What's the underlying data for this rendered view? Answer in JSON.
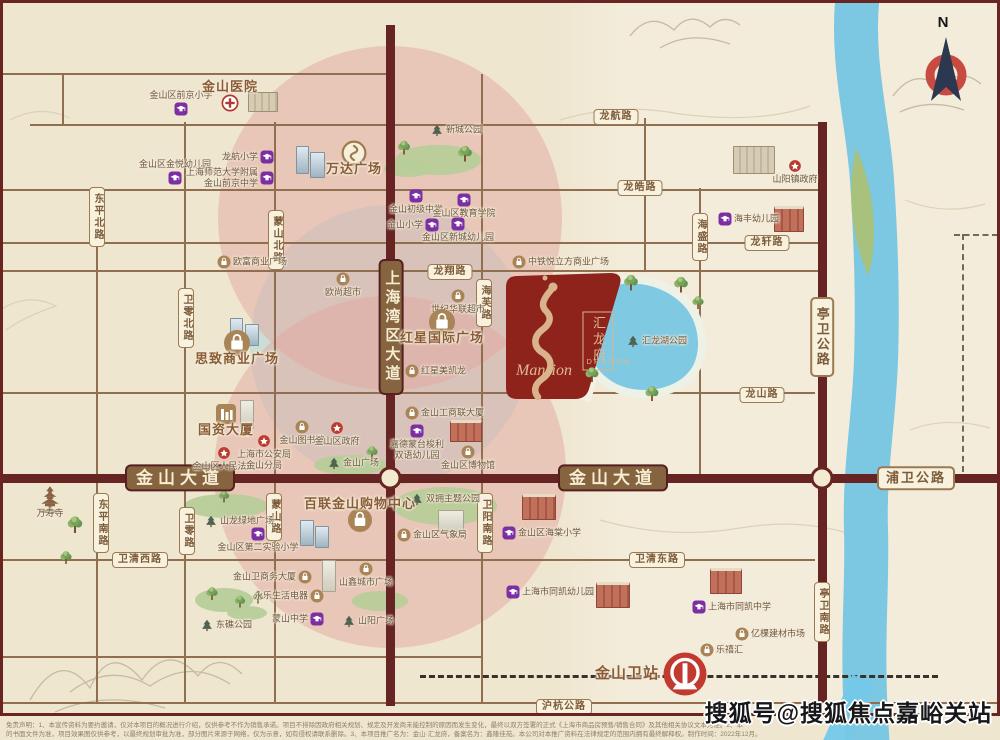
{
  "colors": {
    "background": "#efe6d0",
    "road_minor": "#8f6f50",
    "road_major": "#662423",
    "brand_red": "#8e231c",
    "dragon_gold": "#d8b38c",
    "lake_blue": "#7fc9e3",
    "river_blue": "#7cc7e2",
    "edu_purple": "#7c2fa3",
    "gov_red": "#bb3a2e",
    "shop_brown": "#a88457",
    "ring_pink": "#e3a8a0",
    "ring_blue": "#c6dbd5"
  },
  "property": {
    "name_cn": "汇龙府",
    "en_line1": "DRAGON",
    "en_line2": "Mansion"
  },
  "north": {
    "label": "N"
  },
  "watermark": {
    "text": "搜狐号@搜狐焦点嘉峪关站"
  },
  "disclaimer": {
    "line1": "免责声明：1、本宣传资料为要约邀请，仅对本项目的概况进行介绍，仅供参考不作为销售承诺。项目不排除因政府相关规划、规定及开发商未能控制的原因而发生变化，最终以双方签署的正式《上海市商品房预售/销售合同》及其他相关协议文本为准。2、本",
    "line2": "的书面文件为准，项目效果图仅供参考，以最终规划审批为准，部分图片来源于网络，仅为示意，如有侵权请联系删除。3、本项目推广名为：金山·汇龙府，备案名为：鑫隆佳苑。本公司对本推广资料在法律规定的范围内拥有最终解释权。制作时间：2022年12月。"
  },
  "station": {
    "label": "金山卫站"
  },
  "road_labels": [
    {
      "t": "龙航路",
      "x": 616,
      "y": 117,
      "o": "h",
      "k": "s"
    },
    {
      "t": "龙皓路",
      "x": 640,
      "y": 188,
      "o": "h",
      "k": "s"
    },
    {
      "t": "龙轩路",
      "x": 767,
      "y": 243,
      "o": "h",
      "k": "s"
    },
    {
      "t": "龙翔路",
      "x": 450,
      "y": 272,
      "o": "h",
      "k": "s"
    },
    {
      "t": "龙山路",
      "x": 762,
      "y": 395,
      "o": "h",
      "k": "s"
    },
    {
      "t": "卫清西路",
      "x": 140,
      "y": 560,
      "o": "h",
      "k": "s"
    },
    {
      "t": "卫清东路",
      "x": 657,
      "y": 560,
      "o": "h",
      "k": "s"
    },
    {
      "t": "沪杭公路",
      "x": 564,
      "y": 707,
      "o": "h",
      "k": "s"
    },
    {
      "t": "海芙路",
      "x": 484,
      "y": 303,
      "o": "v",
      "k": "s"
    },
    {
      "t": "海盛路",
      "x": 700,
      "y": 237,
      "o": "v",
      "k": "s"
    },
    {
      "t": "东平北路",
      "x": 97,
      "y": 217,
      "o": "v",
      "k": "s"
    },
    {
      "t": "卫零北路",
      "x": 186,
      "y": 318,
      "o": "v",
      "k": "s"
    },
    {
      "t": "蒙山北路",
      "x": 276,
      "y": 240,
      "o": "v",
      "k": "s"
    },
    {
      "t": "东平南路",
      "x": 101,
      "y": 523,
      "o": "v",
      "k": "s"
    },
    {
      "t": "卫零路",
      "x": 187,
      "y": 531,
      "o": "v",
      "k": "s"
    },
    {
      "t": "蒙山路",
      "x": 274,
      "y": 517,
      "o": "v",
      "k": "s"
    },
    {
      "t": "卫阳南路",
      "x": 485,
      "y": 523,
      "o": "v",
      "k": "s"
    },
    {
      "t": "亭卫南路",
      "x": 822,
      "y": 612,
      "o": "v",
      "k": "s"
    },
    {
      "t": "亭卫公路",
      "x": 822,
      "y": 337,
      "o": "v",
      "k": "sec"
    },
    {
      "t": "浦卫公路",
      "x": 916,
      "y": 478,
      "o": "h",
      "k": "sec"
    },
    {
      "t": "金山大道",
      "x": 180,
      "y": 478,
      "o": "h",
      "k": "m"
    },
    {
      "t": "金山大道",
      "x": 613,
      "y": 478,
      "o": "h",
      "k": "m"
    },
    {
      "t": "上海湾区大道",
      "x": 391,
      "y": 327,
      "o": "v",
      "k": "m"
    }
  ],
  "roads": {
    "h": [
      {
        "y": 74,
        "x1": 3,
        "x2": 390
      },
      {
        "y": 125,
        "x1": 30,
        "x2": 820
      },
      {
        "y": 190,
        "x1": 3,
        "x2": 820
      },
      {
        "y": 243,
        "x1": 3,
        "x2": 818
      },
      {
        "y": 271,
        "x1": 3,
        "x2": 818
      },
      {
        "y": 393,
        "x1": 3,
        "x2": 815
      },
      {
        "y": 560,
        "x1": 3,
        "x2": 815
      },
      {
        "y": 657,
        "x1": 3,
        "x2": 482
      },
      {
        "y": 703,
        "x1": 3,
        "x2": 997
      }
    ],
    "v": [
      {
        "x": 63,
        "y1": 74,
        "y2": 125
      },
      {
        "x": 97,
        "y1": 190,
        "y2": 703
      },
      {
        "x": 185,
        "y1": 122,
        "y2": 703
      },
      {
        "x": 275,
        "y1": 122,
        "y2": 703
      },
      {
        "x": 482,
        "y1": 74,
        "y2": 703
      },
      {
        "x": 645,
        "y1": 118,
        "y2": 272
      },
      {
        "x": 700,
        "y1": 188,
        "y2": 478
      }
    ],
    "major_h": [
      {
        "y": 478,
        "x1": 0,
        "x2": 1000
      }
    ],
    "major_v": [
      {
        "x": 390,
        "y1": 25,
        "y2": 706
      },
      {
        "x": 822,
        "y1": 122,
        "y2": 703
      }
    ],
    "railway": {
      "y": 675,
      "x1": 420,
      "x2": 938
    },
    "nodes": [
      {
        "x": 390,
        "y": 478
      },
      {
        "x": 822,
        "y": 478
      }
    ],
    "dashes": [
      {
        "o": "h",
        "x": 954,
        "y": 234,
        "len": 44
      },
      {
        "o": "v",
        "x": 962,
        "y": 234,
        "len": 238
      }
    ]
  },
  "pois": [
    {
      "ic": "edu",
      "t": "金山区前京小学",
      "x": 181,
      "y": 109,
      "side": "t"
    },
    {
      "ic": "edu",
      "t": "金山区金悦幼儿园",
      "x": 175,
      "y": 178,
      "side": "t"
    },
    {
      "ic": "edu",
      "t": "龙航小学",
      "x": 267,
      "y": 157,
      "side": "l"
    },
    {
      "ic": "edu",
      "t": [
        "上海师范大学附属",
        "金山前京中学"
      ],
      "x": 267,
      "y": 178,
      "side": "l"
    },
    {
      "ic": "edu",
      "t": "金山初级中学",
      "x": 416,
      "y": 196,
      "side": "b"
    },
    {
      "ic": "edu",
      "t": "金山区教育学院",
      "x": 464,
      "y": 200,
      "side": "b"
    },
    {
      "ic": "edu",
      "t": "金山小学",
      "x": 432,
      "y": 225,
      "side": "l"
    },
    {
      "ic": "edu",
      "t": "金山区新城幼儿园",
      "x": 458,
      "y": 224,
      "side": "b"
    },
    {
      "ic": "edu",
      "t": "海丰幼儿园",
      "x": 725,
      "y": 219,
      "side": "r"
    },
    {
      "ic": "edu",
      "t": [
        "嘉德蒙台梭利",
        "双语幼儿园"
      ],
      "x": 417,
      "y": 431,
      "side": "b"
    },
    {
      "ic": "edu",
      "t": "金山区第二实验小学",
      "x": 258,
      "y": 534,
      "side": "b"
    },
    {
      "ic": "edu",
      "t": "金山区海棠小学",
      "x": 509,
      "y": 533,
      "side": "r"
    },
    {
      "ic": "edu",
      "t": "蒙山中学",
      "x": 317,
      "y": 619,
      "side": "l"
    },
    {
      "ic": "edu",
      "t": "上海市同凯幼儿园",
      "x": 513,
      "y": 592,
      "side": "r"
    },
    {
      "ic": "edu",
      "t": "上海市同凯中学",
      "x": 699,
      "y": 607,
      "side": "r"
    },
    {
      "ic": "shop",
      "t": "欧富商业广场",
      "x": 224,
      "y": 262,
      "side": "r"
    },
    {
      "ic": "shop",
      "t": "欧尚超市",
      "x": 343,
      "y": 279,
      "side": "b"
    },
    {
      "ic": "shop",
      "t": "世纪华联超市",
      "x": 458,
      "y": 296,
      "side": "b"
    },
    {
      "ic": "shop",
      "t": "中铁悦立方商业广场",
      "x": 519,
      "y": 262,
      "side": "r"
    },
    {
      "ic": "shop",
      "t": "红星美凯龙",
      "x": 412,
      "y": 371,
      "side": "r"
    },
    {
      "ic": "shop",
      "t": "金山工商联大厦",
      "x": 412,
      "y": 413,
      "side": "r"
    },
    {
      "ic": "shop",
      "t": "金山图书馆",
      "x": 302,
      "y": 427,
      "side": "b"
    },
    {
      "ic": "shop",
      "t": "金山区博物馆",
      "x": 468,
      "y": 452,
      "side": "b"
    },
    {
      "ic": "shop",
      "t": "山鑫城市广场",
      "x": 366,
      "y": 569,
      "side": "b"
    },
    {
      "ic": "shop",
      "t": "金山卫商务大厦",
      "x": 305,
      "y": 577,
      "side": "l"
    },
    {
      "ic": "shop",
      "t": "永乐生活电器",
      "x": 317,
      "y": 596,
      "side": "l"
    },
    {
      "ic": "shop",
      "t": "亿棵建材市场",
      "x": 742,
      "y": 634,
      "side": "r"
    },
    {
      "ic": "shop",
      "t": "乐禧汇",
      "x": 707,
      "y": 650,
      "side": "r"
    },
    {
      "ic": "shop",
      "t": "金山区气象局",
      "x": 404,
      "y": 535,
      "side": "r"
    },
    {
      "ic": "hospital",
      "t": "金山医院",
      "x": 230,
      "y": 103,
      "side": "t",
      "big": true,
      "s": 17
    },
    {
      "ic": "gov",
      "t": "山阳镇政府",
      "x": 795,
      "y": 166,
      "side": "b"
    },
    {
      "ic": "gov",
      "t": "金山区政府",
      "x": 337,
      "y": 428,
      "side": "b"
    },
    {
      "ic": "gov",
      "t": "金山区人民法院",
      "x": 224,
      "y": 453,
      "side": "b"
    },
    {
      "ic": "gov",
      "t": [
        "上海市公安局",
        "金山分局"
      ],
      "x": 264,
      "y": 441,
      "side": "b"
    },
    {
      "ic": "park",
      "t": "新城公园",
      "x": 437,
      "y": 130,
      "side": "r"
    },
    {
      "ic": "park",
      "t": "金山广场",
      "x": 334,
      "y": 463,
      "side": "r"
    },
    {
      "ic": "park",
      "t": "双拥主题公园",
      "x": 417,
      "y": 499,
      "side": "r"
    },
    {
      "ic": "park",
      "t": "山阳广场",
      "x": 349,
      "y": 621,
      "side": "r"
    },
    {
      "ic": "park",
      "t": "东礁公园",
      "x": 207,
      "y": 625,
      "side": "r"
    },
    {
      "ic": "park",
      "t": "汇龙湖公园",
      "x": 633,
      "y": 341,
      "side": "r"
    },
    {
      "ic": "park",
      "t": "山龙绿地广场",
      "x": 211,
      "y": 521,
      "side": "r"
    },
    {
      "ic": "temple",
      "t": "万寿寺",
      "x": 50,
      "y": 500,
      "side": "b",
      "s": 30
    },
    {
      "ic": "wanda",
      "t": "万达广场",
      "x": 354,
      "y": 153,
      "side": "b",
      "big": true,
      "s": 26
    },
    {
      "ic": "bag",
      "t": "红星国际广场",
      "x": 442,
      "y": 322,
      "side": "b",
      "big": true,
      "s": 26
    },
    {
      "ic": "bag",
      "t": "思致商业广场",
      "x": 237,
      "y": 343,
      "side": "b",
      "big": true,
      "s": 26
    },
    {
      "ic": "office",
      "t": "国资大厦",
      "x": 226,
      "y": 414,
      "side": "b",
      "big": true,
      "s": 20
    },
    {
      "ic": "bag",
      "t": "百联金山购物中心",
      "x": 360,
      "y": 520,
      "side": "t",
      "big": true,
      "s": 24
    },
    {
      "ic": "stationIc",
      "t": "金山卫站",
      "x": 685,
      "y": 674,
      "side": "l",
      "big": true,
      "s": 46,
      "cls": "station"
    }
  ],
  "trees": [
    {
      "x": 404,
      "y": 150,
      "s": 14
    },
    {
      "x": 465,
      "y": 156,
      "s": 16
    },
    {
      "x": 631,
      "y": 285,
      "s": 16
    },
    {
      "x": 681,
      "y": 287,
      "s": 16
    },
    {
      "x": 592,
      "y": 377,
      "s": 15
    },
    {
      "x": 698,
      "y": 305,
      "s": 13
    },
    {
      "x": 75,
      "y": 527,
      "s": 17
    },
    {
      "x": 372,
      "y": 455,
      "s": 13
    },
    {
      "x": 212,
      "y": 596,
      "s": 13
    },
    {
      "x": 240,
      "y": 604,
      "s": 12
    },
    {
      "x": 224,
      "y": 499,
      "s": 12
    },
    {
      "x": 258,
      "y": 600,
      "s": 12
    },
    {
      "x": 66,
      "y": 560,
      "s": 13
    },
    {
      "x": 652,
      "y": 396,
      "s": 15
    }
  ],
  "patches": [
    {
      "x": 438,
      "y": 160,
      "w": 86,
      "h": 30
    },
    {
      "x": 408,
      "y": 169,
      "w": 48,
      "h": 16
    },
    {
      "x": 350,
      "y": 465,
      "w": 72,
      "h": 20
    },
    {
      "x": 445,
      "y": 506,
      "w": 104,
      "h": 38
    },
    {
      "x": 380,
      "y": 601,
      "w": 56,
      "h": 20
    },
    {
      "x": 224,
      "y": 600,
      "w": 58,
      "h": 24
    },
    {
      "x": 247,
      "y": 613,
      "w": 40,
      "h": 14
    },
    {
      "x": 226,
      "y": 506,
      "w": 84,
      "h": 24
    }
  ],
  "buildings": [
    {
      "x": 296,
      "y": 146,
      "w": 11,
      "h": 26,
      "c": "tower"
    },
    {
      "x": 310,
      "y": 152,
      "w": 13,
      "h": 24,
      "c": "tower"
    },
    {
      "x": 248,
      "y": 92,
      "w": 28,
      "h": 18,
      "c": "block"
    },
    {
      "x": 733,
      "y": 146,
      "w": 40,
      "h": 26,
      "c": "block"
    },
    {
      "x": 774,
      "y": 206,
      "w": 28,
      "h": 22,
      "c": "school"
    },
    {
      "x": 230,
      "y": 318,
      "w": 11,
      "h": 24,
      "c": "tower"
    },
    {
      "x": 245,
      "y": 324,
      "w": 12,
      "h": 20,
      "c": "tower"
    },
    {
      "x": 240,
      "y": 400,
      "w": 12,
      "h": 27,
      "c": "light"
    },
    {
      "x": 300,
      "y": 520,
      "w": 12,
      "h": 24,
      "c": "tower"
    },
    {
      "x": 315,
      "y": 526,
      "w": 12,
      "h": 20,
      "c": "tower"
    },
    {
      "x": 322,
      "y": 560,
      "w": 12,
      "h": 30,
      "c": "light"
    },
    {
      "x": 438,
      "y": 510,
      "w": 24,
      "h": 20,
      "c": "light"
    },
    {
      "x": 522,
      "y": 494,
      "w": 32,
      "h": 22,
      "c": "school"
    },
    {
      "x": 596,
      "y": 582,
      "w": 32,
      "h": 22,
      "c": "school"
    },
    {
      "x": 710,
      "y": 568,
      "w": 30,
      "h": 22,
      "c": "school"
    },
    {
      "x": 450,
      "y": 420,
      "w": 30,
      "h": 18,
      "c": "school"
    }
  ]
}
